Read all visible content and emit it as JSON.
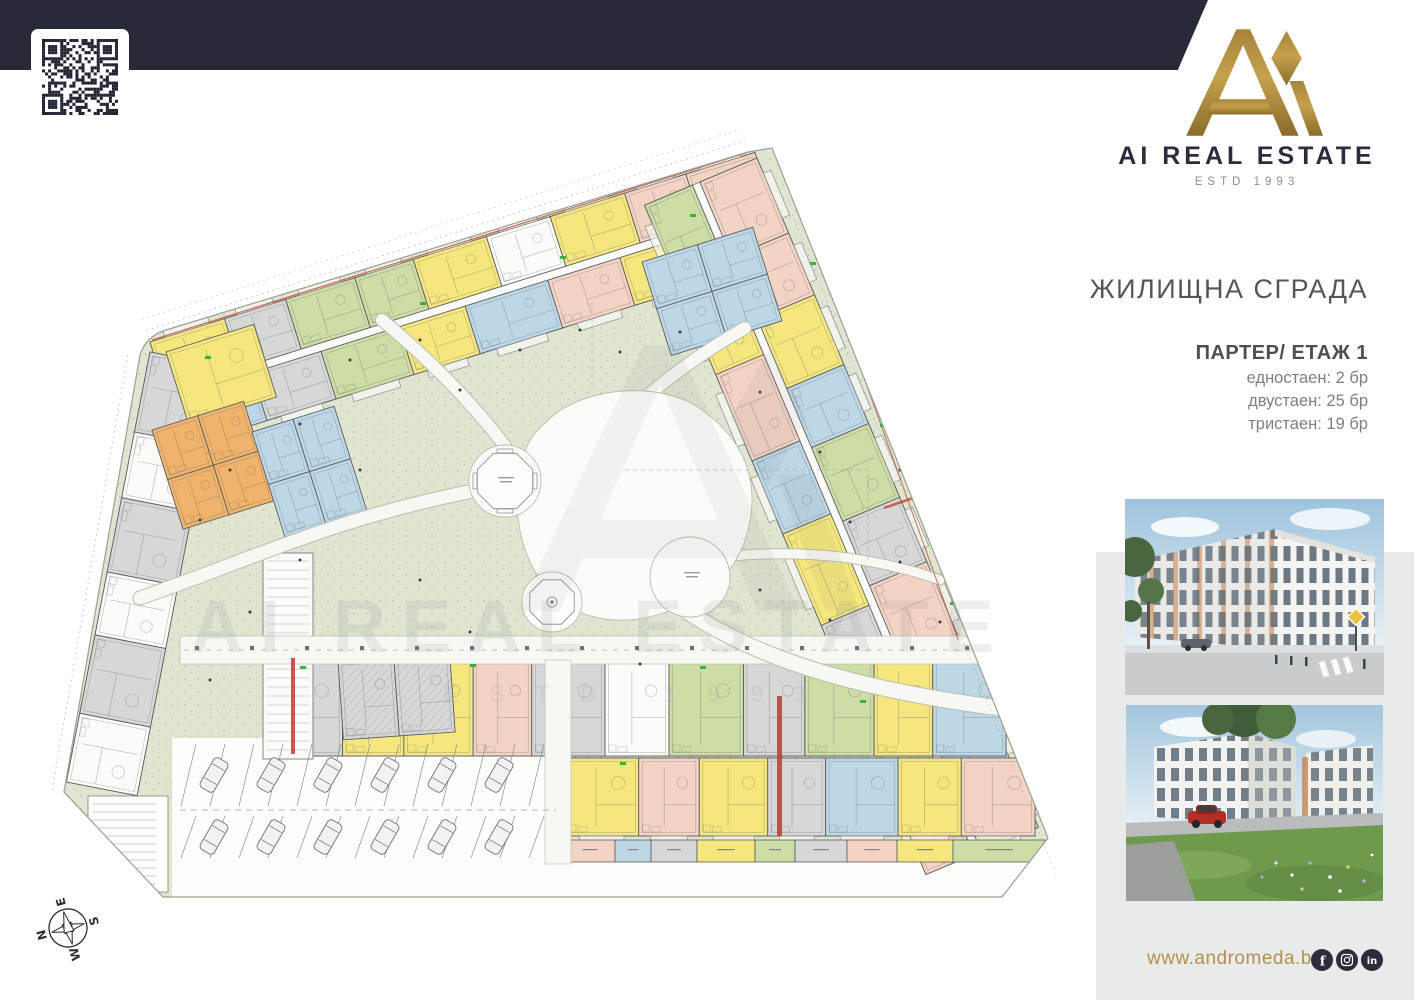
{
  "brand": {
    "name": "AI REAL ESTATE",
    "estd": "ESTD 1993",
    "navy": "#282a39",
    "gold": "#b3914c"
  },
  "listing": {
    "title": "ЖИЛИЩНА СГРАДА",
    "floor_label": "ПАРТЕР/ ЕТАЖ 1",
    "stats": [
      {
        "text": "едностаен: 2 бр"
      },
      {
        "text": "двустаен: 25 бр"
      },
      {
        "text": "тристаен: 19 бр"
      }
    ]
  },
  "watermark": {
    "text": "AI REAL ESTATE",
    "sub": "ESTD 1993"
  },
  "compass": {
    "n": "N",
    "e": "E",
    "s": "S",
    "w": "W"
  },
  "footer": {
    "website": "www.andromeda.bg",
    "social": [
      "facebook",
      "instagram",
      "linkedin"
    ]
  },
  "qr": {
    "modules": 25,
    "seed": 7
  },
  "plan": {
    "palette": {
      "band": "#dfe5d1",
      "yellow": "#f5e77e",
      "salmon": "#f3d3c3",
      "blue": "#bdd7e6",
      "green": "#cedca6",
      "gray": "#d6d7d6",
      "orange": "#f0b36b",
      "white": "#fbfbfa",
      "wall": "#5b5c5f",
      "path": "#f7f8f3",
      "pathEdge": "#b9bdae",
      "red": "#c0392b",
      "mark": "#2fae3c",
      "dot": "#3d3e40"
    },
    "wings": {
      "top_outer": [
        "yellow",
        "gray",
        "green",
        "green",
        "yellow",
        "white",
        "yellow",
        "salmon",
        "salmon"
      ],
      "top_inner": [
        "blue",
        "gray",
        "green",
        "yellow",
        "blue",
        "salmon",
        "yellow",
        "blue"
      ],
      "right_outer": [
        "salmon",
        "salmon",
        "yellow",
        "blue",
        "green",
        "gray",
        "salmon",
        "yellow",
        "blue",
        "green"
      ],
      "right_inner": [
        "green",
        "yellow",
        "salmon",
        "blue",
        "yellow",
        "gray",
        "green",
        "salmon"
      ],
      "bottom_main": [
        "gray",
        "yellow",
        "yellow",
        "salmon",
        "gray",
        "white",
        "green",
        "gray",
        "green",
        "yellow",
        "blue"
      ],
      "bottom_lower": [
        "yellow",
        "salmon",
        "yellow",
        "gray",
        "blue",
        "yellow",
        "salmon"
      ],
      "bottom_strip": [
        "salmon",
        "blue",
        "gray",
        "yellow",
        "green",
        "gray",
        "salmon",
        "yellow",
        "green"
      ],
      "left": [
        "gray",
        "white",
        "gray",
        "white",
        "gray",
        "white"
      ]
    },
    "parking": {
      "rows": 2,
      "cars_per_row": 6,
      "stalls_per_row": 13
    }
  }
}
